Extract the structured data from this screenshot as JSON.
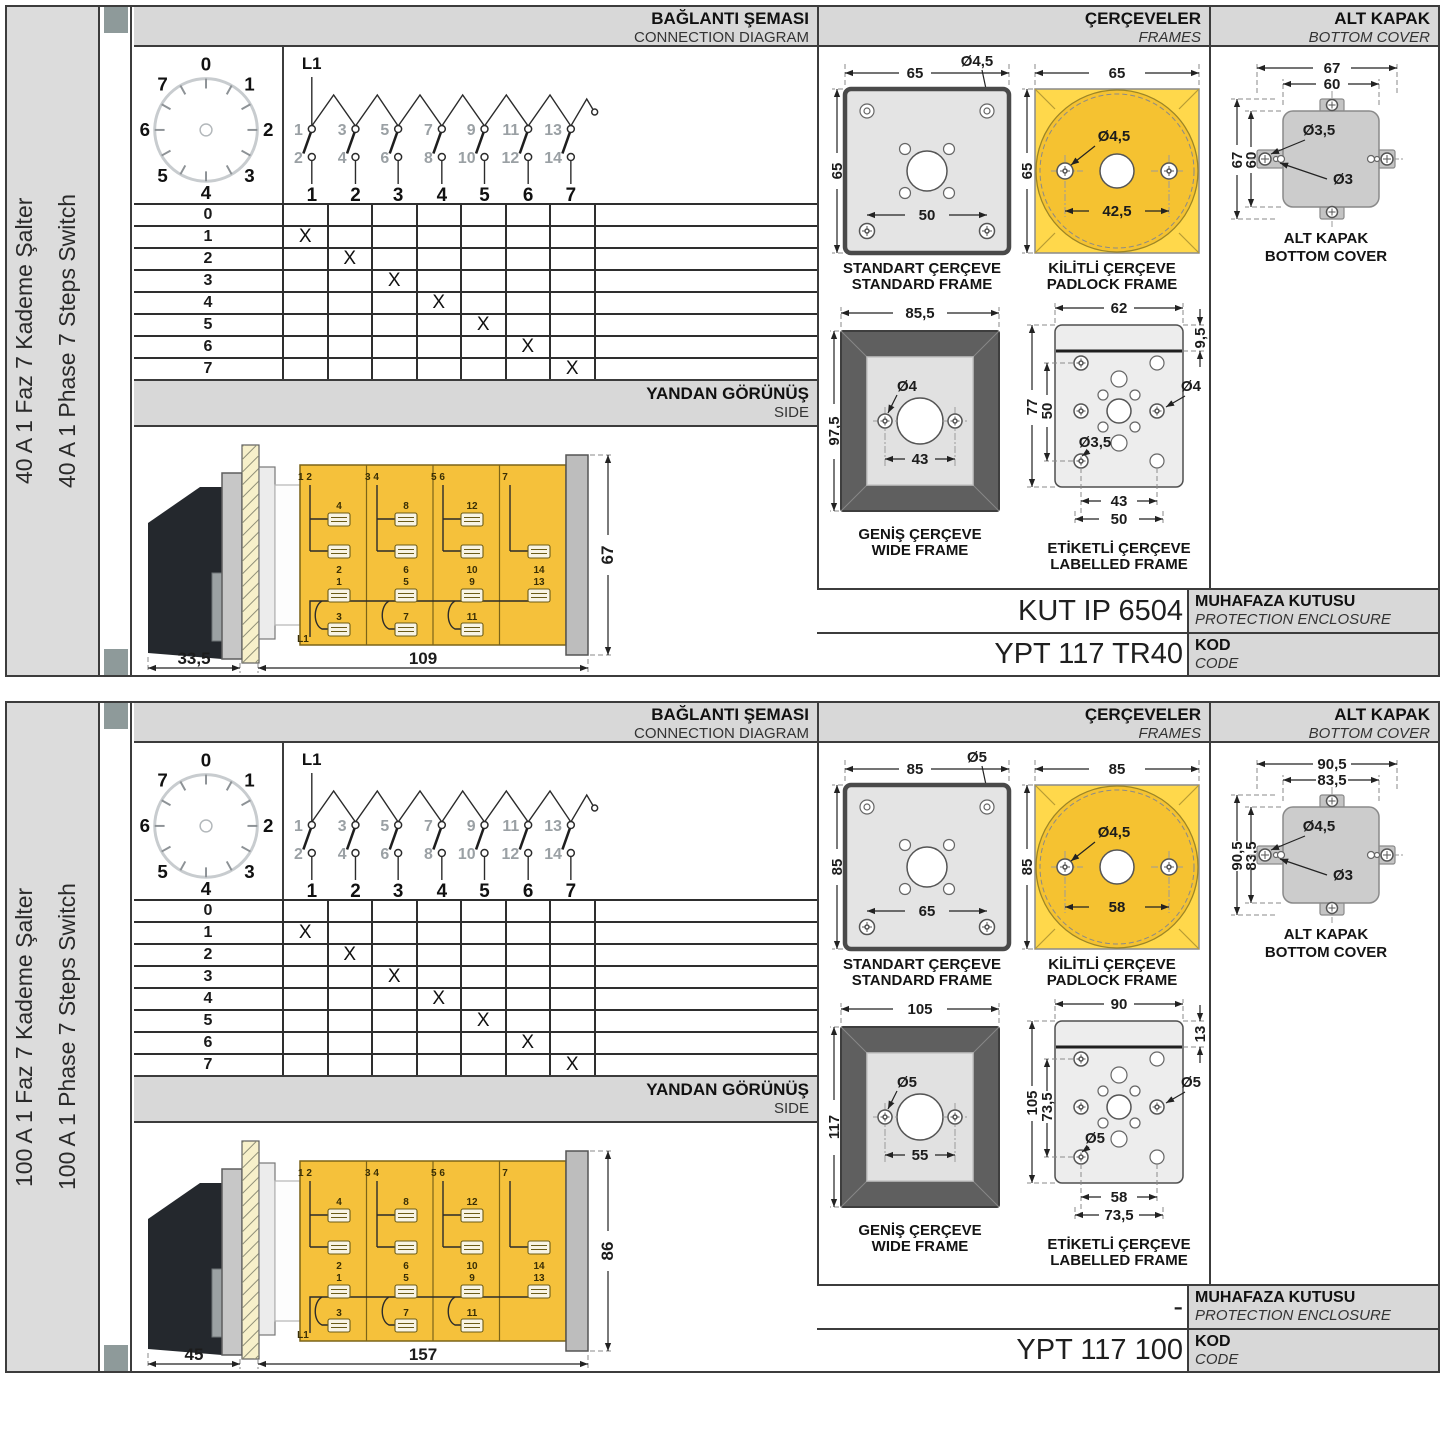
{
  "colors": {
    "switch_body_yellow": "#f5c13b",
    "padlock_frame_yellow": "#ffd84b",
    "panel_gray": "#d8d8d8",
    "marker_gray": "#8e9a9a"
  },
  "sections": [
    {
      "left_label_tr": "40 A 1 Faz 7 Kademe Şalter",
      "left_label_en": "40 A 1 Phase 7 Steps Switch",
      "headers": {
        "connection_tr": "BAĞLANTI ŞEMASI",
        "connection_en": "CONNECTION DIAGRAM",
        "frames_tr": "ÇERÇEVELER",
        "frames_en": "FRAMES",
        "cover_tr": "ALT KAPAK",
        "cover_en": "BOTTOM COVER",
        "side_tr": "YANDAN GÖRÜNÜŞ",
        "side_en": "SIDE"
      },
      "dial": {
        "labels": [
          "0",
          "1",
          "2",
          "3",
          "4",
          "5",
          "6",
          "7"
        ]
      },
      "contacts": {
        "l1": "L1",
        "odd": [
          "1",
          "3",
          "5",
          "7",
          "9",
          "11",
          "13"
        ],
        "even": [
          "2",
          "4",
          "6",
          "8",
          "10",
          "12",
          "14"
        ],
        "poles": [
          "1",
          "2",
          "3",
          "4",
          "5",
          "6",
          "7"
        ]
      },
      "table": {
        "rows": [
          "0",
          "1",
          "2",
          "3",
          "4",
          "5",
          "6",
          "7"
        ],
        "mark": "X"
      },
      "side": {
        "corners": [
          "1 2",
          "3 4",
          "5 6",
          "7"
        ],
        "row_a": [
          "4",
          "8",
          "12"
        ],
        "row_b": [
          "2",
          "6",
          "10",
          "14"
        ],
        "row_c": [
          "1",
          "5",
          "9",
          "13"
        ],
        "row_d": [
          "3",
          "7",
          "11"
        ],
        "l1": "L1",
        "dim_front": "33,5",
        "dim_body": "109",
        "dim_height": "67"
      },
      "frames": {
        "standard": {
          "label_tr": "STANDART ÇERÇEVE",
          "label_en": "STANDARD FRAME",
          "dim_width": "65",
          "dim_height": "65",
          "dim_hole": "Ø4,5",
          "dim_inner": "50"
        },
        "padlock": {
          "label_tr": "KİLİTLİ ÇERÇEVE",
          "label_en": "PADLOCK FRAME",
          "dim_width": "65",
          "dim_height": "65",
          "dim_hole": "Ø4,5",
          "dim_span": "42,5"
        },
        "wide": {
          "label_tr": "GENİŞ ÇERÇEVE",
          "label_en": "WIDE FRAME",
          "dim_width": "85,5",
          "dim_height": "97,5",
          "dim_hole": "Ø4",
          "dim_span": "43"
        },
        "labelled": {
          "label_tr": "ETİKETLİ ÇERÇEVE",
          "label_en": "LABELLED FRAME",
          "dim_top": "62",
          "dim_tab": "9,5",
          "dim_height": "77",
          "dim_inner_height": "50",
          "dim_hole_right": "Ø4",
          "dim_hole_left": "Ø3,5",
          "dim_span1": "43",
          "dim_span2": "50"
        }
      },
      "cover": {
        "label_tr": "ALT KAPAK",
        "label_en": "BOTTOM COVER",
        "dim_outer_w": "67",
        "dim_inner_w": "60",
        "dim_outer_h": "67",
        "dim_inner_h": "60",
        "dim_hole_big": "Ø3,5",
        "dim_hole_small": "Ø3"
      },
      "enclosure": {
        "value": "KUT IP 6504",
        "label_tr": "MUHAFAZA KUTUSU",
        "label_en": "PROTECTION ENCLOSURE"
      },
      "code": {
        "value": "YPT 117 TR40",
        "label_tr": "KOD",
        "label_en": "CODE"
      }
    },
    {
      "left_label_tr": "100 A 1 Faz 7 Kademe Şalter",
      "left_label_en": "100 A 1 Phase 7 Steps Switch",
      "headers": {
        "connection_tr": "BAĞLANTI ŞEMASI",
        "connection_en": "CONNECTION DIAGRAM",
        "frames_tr": "ÇERÇEVELER",
        "frames_en": "FRAMES",
        "cover_tr": "ALT KAPAK",
        "cover_en": "BOTTOM COVER",
        "side_tr": "YANDAN GÖRÜNÜŞ",
        "side_en": "SIDE"
      },
      "dial": {
        "labels": [
          "0",
          "1",
          "2",
          "3",
          "4",
          "5",
          "6",
          "7"
        ]
      },
      "contacts": {
        "l1": "L1",
        "odd": [
          "1",
          "3",
          "5",
          "7",
          "9",
          "11",
          "13"
        ],
        "even": [
          "2",
          "4",
          "6",
          "8",
          "10",
          "12",
          "14"
        ],
        "poles": [
          "1",
          "2",
          "3",
          "4",
          "5",
          "6",
          "7"
        ]
      },
      "table": {
        "rows": [
          "0",
          "1",
          "2",
          "3",
          "4",
          "5",
          "6",
          "7"
        ],
        "mark": "X"
      },
      "side": {
        "corners": [
          "1 2",
          "3 4",
          "5 6",
          "7"
        ],
        "row_a": [
          "4",
          "8",
          "12"
        ],
        "row_b": [
          "2",
          "6",
          "10",
          "14"
        ],
        "row_c": [
          "1",
          "5",
          "9",
          "13"
        ],
        "row_d": [
          "3",
          "7",
          "11"
        ],
        "l1": "L1",
        "dim_front": "45",
        "dim_body": "157",
        "dim_height": "86"
      },
      "frames": {
        "standard": {
          "label_tr": "STANDART ÇERÇEVE",
          "label_en": "STANDARD FRAME",
          "dim_width": "85",
          "dim_height": "85",
          "dim_hole": "Ø5",
          "dim_inner": "65"
        },
        "padlock": {
          "label_tr": "KİLİTLİ ÇERÇEVE",
          "label_en": "PADLOCK FRAME",
          "dim_width": "85",
          "dim_height": "85",
          "dim_hole": "Ø4,5",
          "dim_span": "58"
        },
        "wide": {
          "label_tr": "GENİŞ ÇERÇEVE",
          "label_en": "WIDE FRAME",
          "dim_width": "105",
          "dim_height": "117",
          "dim_hole": "Ø5",
          "dim_span": "55"
        },
        "labelled": {
          "label_tr": "ETİKETLİ ÇERÇEVE",
          "label_en": "LABELLED FRAME",
          "dim_top": "90",
          "dim_tab": "13",
          "dim_height": "105",
          "dim_inner_height": "73,5",
          "dim_hole_right": "Ø5",
          "dim_hole_left": "Ø5",
          "dim_span1": "58",
          "dim_span2": "73,5"
        }
      },
      "cover": {
        "label_tr": "ALT KAPAK",
        "label_en": "BOTTOM COVER",
        "dim_outer_w": "90,5",
        "dim_inner_w": "83,5",
        "dim_outer_h": "90,5",
        "dim_inner_h": "83,5",
        "dim_hole_big": "Ø4,5",
        "dim_hole_small": "Ø3"
      },
      "enclosure": {
        "value": "-",
        "label_tr": "MUHAFAZA KUTUSU",
        "label_en": "PROTECTION ENCLOSURE"
      },
      "code": {
        "value": "YPT 117 100",
        "label_tr": "KOD",
        "label_en": "CODE"
      }
    }
  ]
}
